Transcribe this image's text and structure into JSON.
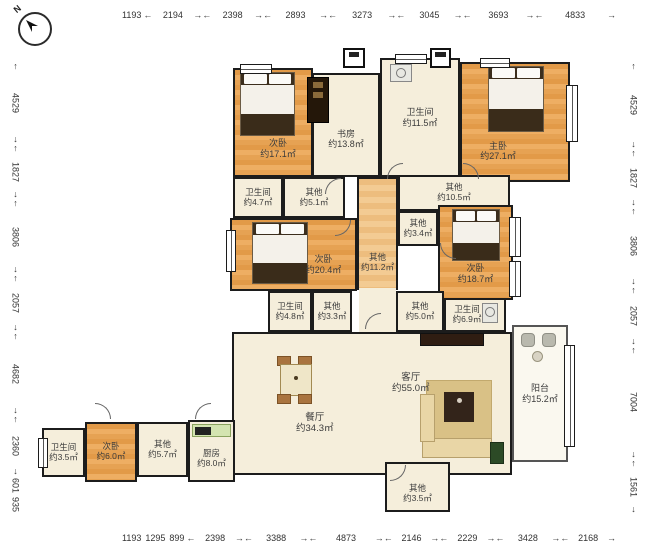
{
  "compass": {
    "label": "N"
  },
  "dims": {
    "top": {
      "plain": [
        "1193"
      ],
      "segments": [
        "2194",
        "2398",
        "2893",
        "3273",
        "3045",
        "3693",
        "4833"
      ]
    },
    "bottom": {
      "plain": [
        "1193",
        "1295",
        "899"
      ],
      "segments": [
        "2398",
        "3388",
        "4873",
        "2146",
        "2229",
        "3428",
        "2168"
      ]
    },
    "left": {
      "segments": [
        "4529",
        "1827",
        "3806",
        "2057",
        "4682",
        "2360"
      ],
      "plain": [
        "601",
        "935"
      ]
    },
    "right": {
      "segments": [
        "4529",
        "1827",
        "3806",
        "2057",
        "7004",
        "1561"
      ]
    }
  },
  "rooms": {
    "bedroom_17": {
      "name": "次卧",
      "area": "约17.1㎡"
    },
    "study": {
      "name": "书房",
      "area": "约13.8㎡"
    },
    "bath_115": {
      "name": "卫生间",
      "area": "约11.5㎡"
    },
    "master": {
      "name": "主卧",
      "area": "约27.1㎡"
    },
    "bath_47": {
      "name": "卫生间",
      "area": "约4.7㎡"
    },
    "other_51": {
      "name": "其他",
      "area": "约5.1㎡"
    },
    "other_105": {
      "name": "其他",
      "area": "约10.5㎡"
    },
    "bedroom_204": {
      "name": "次卧",
      "area": "约20.4㎡"
    },
    "other_112": {
      "name": "其他",
      "area": "约11.2㎡"
    },
    "other_34": {
      "name": "其他",
      "area": "约3.4㎡"
    },
    "bedroom_187": {
      "name": "次卧",
      "area": "约18.7㎡"
    },
    "bath_48": {
      "name": "卫生间",
      "area": "约4.8㎡"
    },
    "other_33": {
      "name": "其他",
      "area": "约3.3㎡"
    },
    "other_50": {
      "name": "其他",
      "area": "约5.0㎡"
    },
    "bath_69": {
      "name": "卫生间",
      "area": "约6.9㎡"
    },
    "living": {
      "name": "客厅",
      "area": "约55.0㎡"
    },
    "dining": {
      "name": "餐厅",
      "area": "约34.3㎡"
    },
    "balcony": {
      "name": "阳台",
      "area": "约15.2㎡"
    },
    "bath_35": {
      "name": "卫生间",
      "area": "约3.5㎡"
    },
    "bedroom_60": {
      "name": "次卧",
      "area": "约6.0㎡"
    },
    "other_57": {
      "name": "其他",
      "area": "约5.7㎡"
    },
    "kitchen": {
      "name": "厨房",
      "area": "约8.0㎡"
    },
    "other_35b": {
      "name": "其他",
      "area": "约3.5㎡"
    }
  },
  "colors": {
    "wood": "#e6a253",
    "cream": "#f5eedb",
    "wall": "#1c1c1c",
    "balcony": "#faf8ef",
    "counter_green": "#d4e4b0"
  }
}
